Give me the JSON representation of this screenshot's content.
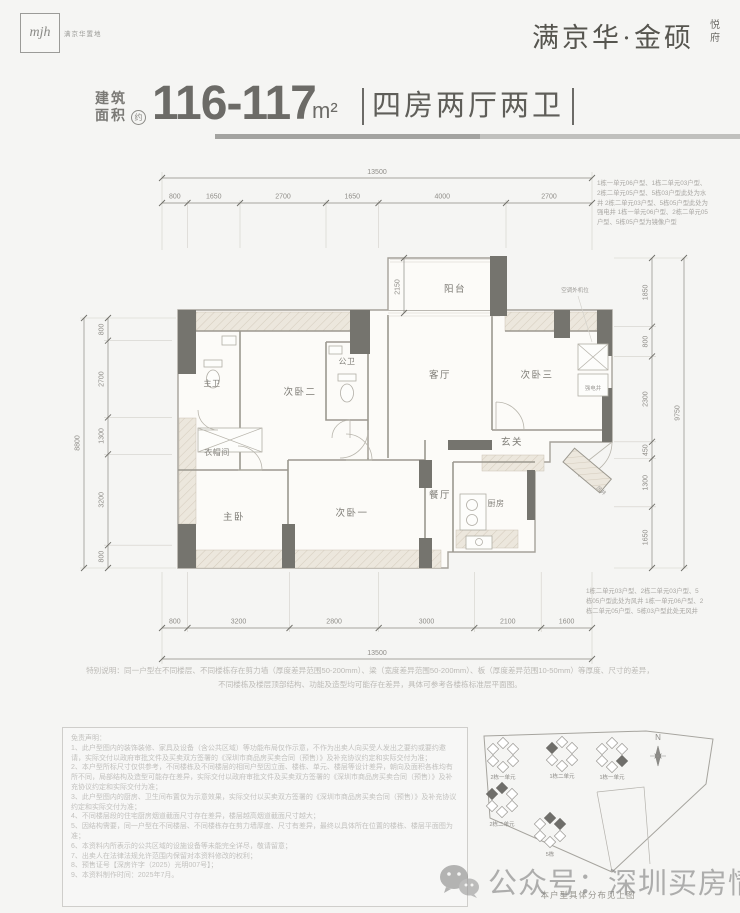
{
  "colors": {
    "wall": "#75746e",
    "hatch": "#ece7dd",
    "dim_text": "#8f8d88",
    "title_text": "#6c6b67",
    "disclaimer_text": "#c2c1be"
  },
  "header": {
    "logo_text": "mjh",
    "logo_caption": "满京华置地",
    "brand": "满京华·金硕",
    "brand_sub1": "悦",
    "brand_sub2": "府"
  },
  "title": {
    "area_label_line1": "建筑",
    "area_label_line2": "面积",
    "approx_badge": "约",
    "area_value": "116-117",
    "area_unit": "m²",
    "layout": "四房两厅两卫"
  },
  "plan": {
    "rooms": {
      "balcony": "阳台",
      "living": "客厅",
      "bedroom2": "次卧二",
      "bedroom3": "次卧三",
      "bedroom1": "次卧一",
      "master": "主卧",
      "public_bath": "公卫",
      "master_bath": "主卫",
      "cloakroom": "衣帽间",
      "foyer": "玄关",
      "dining": "餐厅",
      "kitchen": "厨房"
    },
    "annotations": {
      "ac_unit": "空调外机位",
      "elec_shaft": "强电井",
      "wind_shaft": "风井",
      "balcony_depth": "2150"
    },
    "dims": {
      "top_total": "13500",
      "top": [
        "800",
        "1650",
        "2700",
        "1650",
        "4000",
        "2700"
      ],
      "bottom": [
        "800",
        "3200",
        "2800",
        "3000",
        "2100",
        "1600"
      ],
      "bottom_total": "13500",
      "left": [
        "800",
        "2700",
        "1300",
        "3200",
        "800"
      ],
      "left_total": "8800",
      "right": [
        "1850",
        "800",
        "2300",
        "450",
        "1300",
        "1650"
      ],
      "right_total": "9750"
    },
    "note_top_right": "1栋一单元06户型、1栋二单元03户型、2栋二单元05户型、5栋03户型此处为水井 2栋二单元03户型、5栋05户型此处为强电井 1栋一单元06户型、2栋二单元05户型、5栋05户型为镜像户型",
    "note_bottom_right": "1栋二单元03户型、2栋二单元03户型、5栋05户型此处为风井 1栋一单元06户型、2栋二单元05户型、5栋03户型此处无风井"
  },
  "special_note": {
    "line1": "特别说明：同一户型在不同楼层、不同楼栋存在剪力墙（厚度差异范围50-200mm）、梁（宽度差异范围50-200mm）、板（厚度差异范围10-50mm）等厚度、尺寸的差异，",
    "line2": "不同楼栋及楼层顶部结构、功能及造型均可能存在差异，具体可参考各楼栋标准层平面图。"
  },
  "disclaimer": {
    "title": "免责声明：",
    "items": [
      "1、此户型图内的装饰装修、家具及设备（含公共区域）等功能布局仅作示意，不作为出卖人向买受人发出之要约或要约邀请，实际交付以政府审批文件及买卖双方签署的《深圳市商品房买卖合同（预售）》及补充协议约定和实际交付为准；",
      "2、本户型所标尺寸仅供参考，不同楼栋及不同楼层的相同户型因立面、楼栋、单元、楼层等设计差异，朝向及面积各栋均有所不同，局部结构及造型可能存在差异，实际交付以政府审批文件及买卖双方签署的《深圳市商品房买卖合同（预售）》及补充协议约定和实际交付为准；",
      "3、此户型图内的厨房、卫生间布置仅为示意效果，实际交付以买卖双方签署的《深圳市商品房买卖合同（预售）》及补充协议约定和实际交付为准；",
      "4、不同楼层段的住宅厨房烟道截面尺寸存在差异，楼层越高烟道截面尺寸越大；",
      "5、因结构需要，同一户型在不同楼层、不同楼栋存在剪力墙厚度、尺寸有差异，最终以具体所在位置的楼栋、楼层平面图为准；",
      "6、本资料内所表示的公共区域的设施设备等未能完全详尽，敬请留意；",
      "7、出卖人在法律法规允许范围内保留对本资料修改的权利；",
      "8、预售证号【深房许字（2025）光明007号】；",
      "9、本资料制作时间：2025年7月。"
    ]
  },
  "siteplan": {
    "clusters": [
      "2栋一单元",
      "1栋二单元",
      "1栋一单元",
      "2栋二单元",
      "5栋"
    ],
    "north": "N",
    "caption": "本户型具体分布见上图"
  },
  "watermark": "公众号：深圳买房情报"
}
